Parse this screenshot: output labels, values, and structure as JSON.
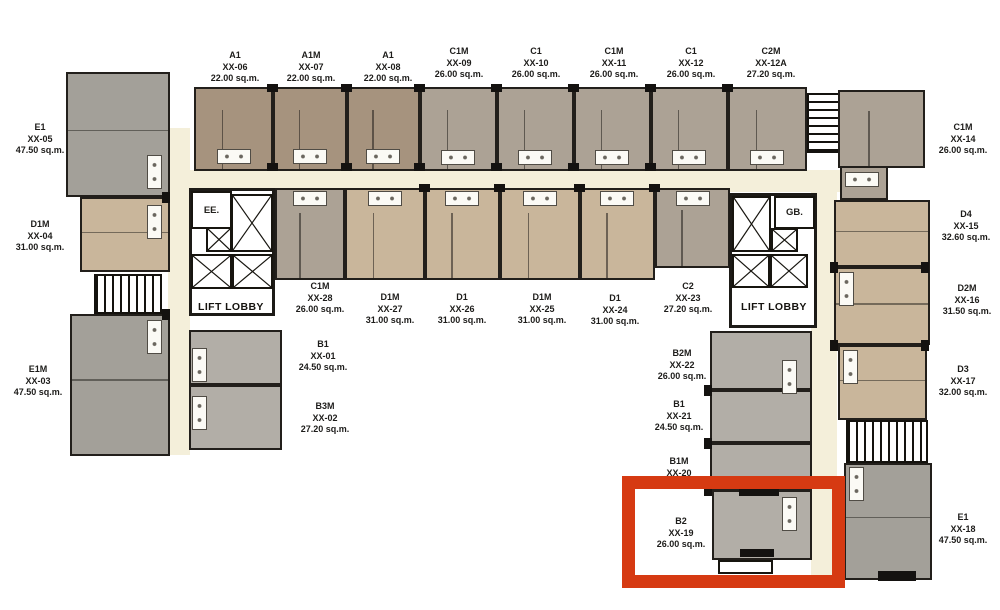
{
  "units": {
    "u01": {
      "type": "B1",
      "no": "XX-01",
      "area": "24.50 sq.m."
    },
    "u02": {
      "type": "B3M",
      "no": "XX-02",
      "area": "27.20 sq.m."
    },
    "u03": {
      "type": "E1M",
      "no": "XX-03",
      "area": "47.50 sq.m."
    },
    "u04": {
      "type": "D1M",
      "no": "XX-04",
      "area": "31.00 sq.m."
    },
    "u05": {
      "type": "E1",
      "no": "XX-05",
      "area": "47.50 sq.m."
    },
    "u06": {
      "type": "A1",
      "no": "XX-06",
      "area": "22.00 sq.m."
    },
    "u07": {
      "type": "A1M",
      "no": "XX-07",
      "area": "22.00 sq.m."
    },
    "u08": {
      "type": "A1",
      "no": "XX-08",
      "area": "22.00 sq.m."
    },
    "u09": {
      "type": "C1M",
      "no": "XX-09",
      "area": "26.00 sq.m."
    },
    "u10": {
      "type": "C1",
      "no": "XX-10",
      "area": "26.00 sq.m."
    },
    "u11": {
      "type": "C1M",
      "no": "XX-11",
      "area": "26.00 sq.m."
    },
    "u12": {
      "type": "C1",
      "no": "XX-12",
      "area": "26.00 sq.m."
    },
    "u12a": {
      "type": "C2M",
      "no": "XX-12A",
      "area": "27.20 sq.m."
    },
    "u14": {
      "type": "C1M",
      "no": "XX-14",
      "area": "26.00 sq.m."
    },
    "u15": {
      "type": "D4",
      "no": "XX-15",
      "area": "32.60 sq.m."
    },
    "u16": {
      "type": "D2M",
      "no": "XX-16",
      "area": "31.50 sq.m."
    },
    "u17": {
      "type": "D3",
      "no": "XX-17",
      "area": "32.00 sq.m."
    },
    "u18": {
      "type": "E1",
      "no": "XX-18",
      "area": "47.50 sq.m."
    },
    "u19": {
      "type": "B2",
      "no": "XX-19",
      "area": "26.00 sq.m."
    },
    "u20": {
      "type": "B1M",
      "no": "XX-20",
      "area": ""
    },
    "u21": {
      "type": "B1",
      "no": "XX-21",
      "area": "24.50 sq.m."
    },
    "u22": {
      "type": "B2M",
      "no": "XX-22",
      "area": "26.00 sq.m."
    },
    "u23": {
      "type": "C2",
      "no": "XX-23",
      "area": "27.20 sq.m."
    },
    "u24": {
      "type": "D1",
      "no": "XX-24",
      "area": "31.00 sq.m."
    },
    "u25": {
      "type": "D1M",
      "no": "XX-25",
      "area": "31.00 sq.m."
    },
    "u26": {
      "type": "D1",
      "no": "XX-26",
      "area": "31.00 sq.m."
    },
    "u27": {
      "type": "D1M",
      "no": "XX-27",
      "area": "31.00 sq.m."
    },
    "u28": {
      "type": "C1M",
      "no": "XX-28",
      "area": "26.00 sq.m."
    }
  },
  "rooms": {
    "ee": "EE.",
    "gb": "GB.",
    "lift_lobby_left": "LIFT LOBBY",
    "lift_lobby_right": "LIFT LOBBY"
  },
  "highlight": {
    "highlighted_unit_no": "XX-19",
    "color": "#d63a12"
  },
  "colors": {
    "a_unit": "#a6937e",
    "c_unit": "#aca295",
    "d_unit": "#c9b69b",
    "e_unit": "#a3a099",
    "b_unit": "#b2aea7",
    "corridor": "#f4efda",
    "wall": "#221f1b"
  }
}
